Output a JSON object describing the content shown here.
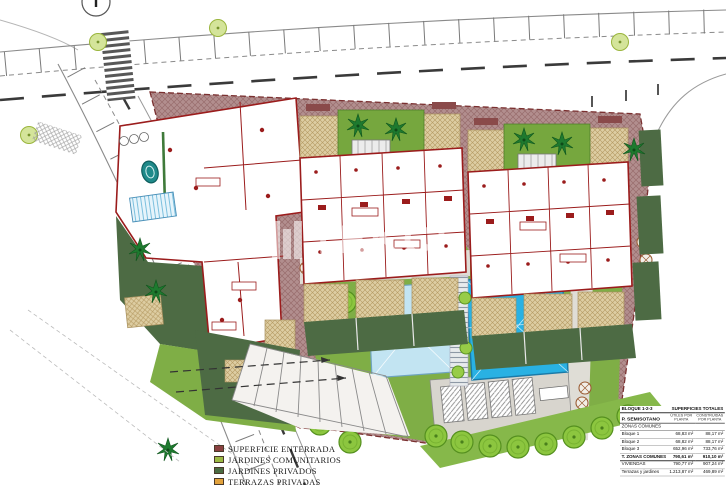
{
  "watermark": {
    "text": "TEKCE"
  },
  "legend": {
    "items": [
      {
        "label": "SUPERFICIE ENTERRADA",
        "color": "#8a4040"
      },
      {
        "label": "JARDINES COMUNITARIOS",
        "color": "#9cba44"
      },
      {
        "label": "JARDINES PRIVADOS",
        "color": "#4a6b42"
      },
      {
        "label": "TERRAZAS PRIVADAS",
        "color": "#e2a23c"
      }
    ]
  },
  "summary_table": {
    "title_left": "BLOQUE 1-2-3",
    "title_right": "SUPERFICIES TOTALES",
    "floor_label": "P. SEMISOTANO",
    "col_util": "ÚTILES POR PLANTA",
    "col_built": "CONSTRUIDAS POR PLANTA",
    "section_label": "ZONAS COMUNES",
    "rows": [
      {
        "label": "Bloque 1",
        "util": "68,83 m²",
        "built": "88,17 m²"
      },
      {
        "label": "Bloque 2",
        "util": "68,82 m²",
        "built": "88,17 m²"
      },
      {
        "label": "Bloque 3",
        "util": "652,96 m²",
        "built": "733,76 m²"
      }
    ],
    "total_row": {
      "label": "T. ZONAS COMUNES",
      "util": "790,61 m²",
      "built": "910,10 m²"
    },
    "extra_rows": [
      {
        "label": "VIVIENDAS",
        "util": "790,77 m²",
        "built": "907,24 m²"
      },
      {
        "label": "Terrazas y jardines",
        "util": "1.213,87 m²",
        "built": "469,89 m²"
      }
    ]
  },
  "colors": {
    "parcel_hatch": "#b28e8e",
    "communal_garden": "#7fae46",
    "private_garden": "#4d6b44",
    "terrace_tan": "#ddcda2",
    "pool_main": "#29b1e3",
    "pool_small": "#c2e4f2",
    "wall_red": "#9b1c1c",
    "tree_green": "#8cc63f"
  }
}
